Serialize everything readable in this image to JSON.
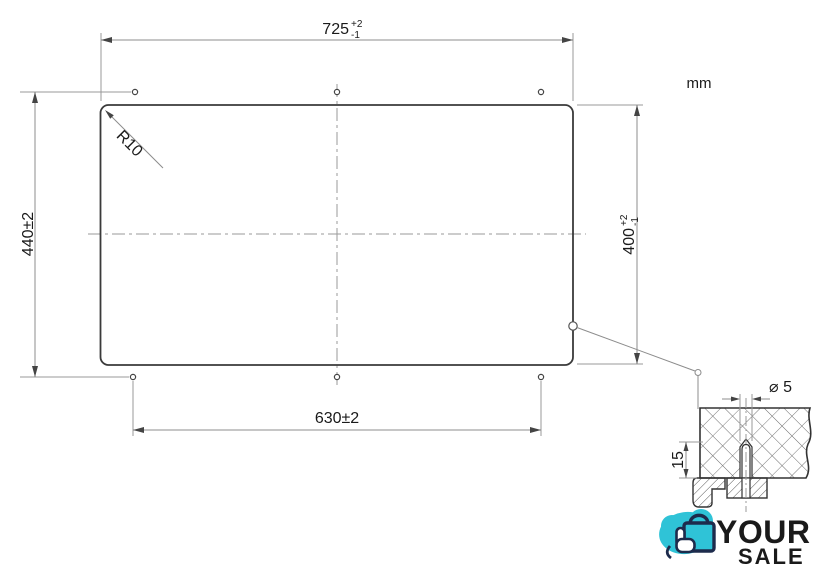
{
  "unit_label": "mm",
  "dims": {
    "top_width": {
      "value": "725",
      "tol_up": "+2",
      "tol_down": "-1"
    },
    "right_height": {
      "value": "400",
      "tol_up": "+2",
      "tol_down": "-1"
    },
    "left_span": "440±2",
    "bottom_span": "630±2",
    "corner_radius": "R10"
  },
  "detail": {
    "hole_diameter": "⌀ 5",
    "hole_depth": "15"
  },
  "logo": {
    "word_top": "YOUR",
    "word_bottom": "SALE"
  },
  "colors": {
    "object_line": "#3a3a3a",
    "dim_line": "#8c8c8c",
    "logo_navy": "#1d2b4c",
    "logo_teal": "#2fc3d7"
  }
}
